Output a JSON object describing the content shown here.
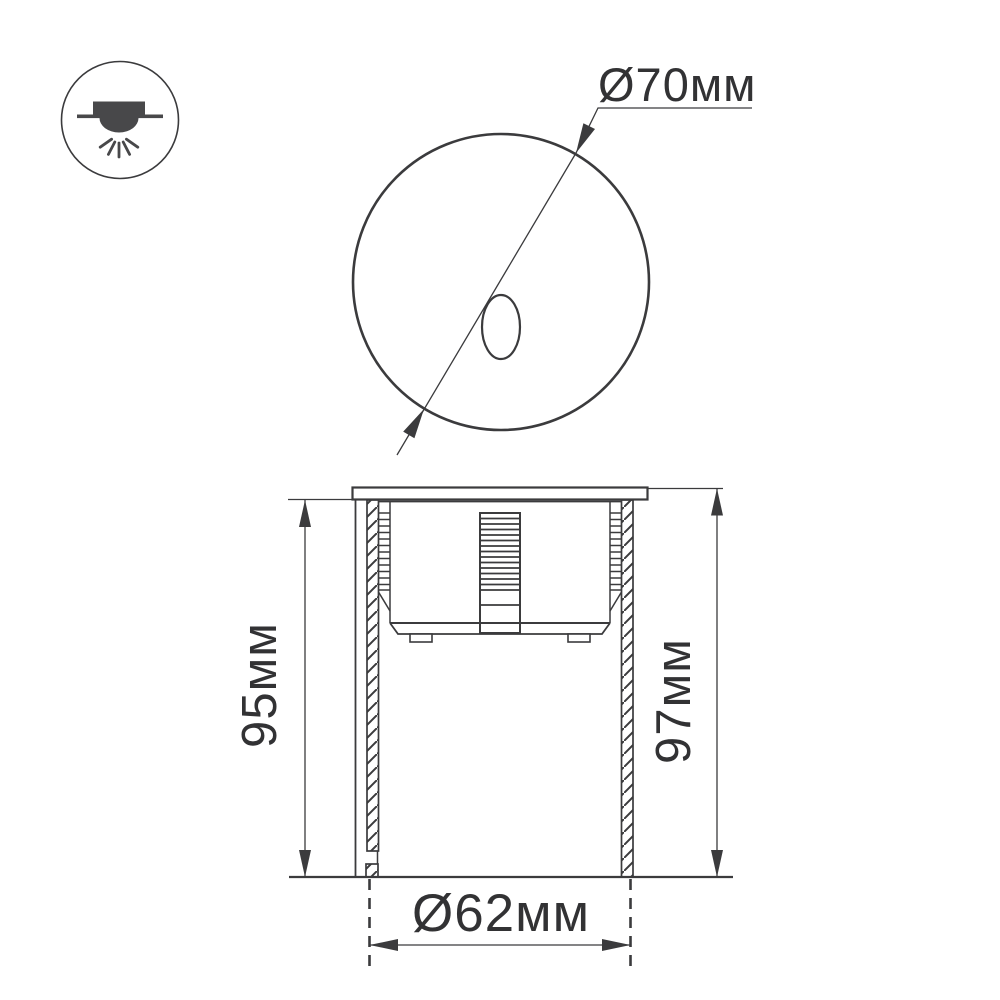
{
  "drawing": {
    "title_semantics": "recessed luminaire dimensional drawing",
    "dimensions": {
      "top_diameter": "Ø70мм",
      "height_left": "95мм",
      "height_right": "97мм",
      "bottom_diameter": "Ø62мм"
    },
    "icon": "recessed-downlight",
    "colors": {
      "line": "#3b3b3d",
      "text": "#323234",
      "icon_fill": "#48484a",
      "background": "#ffffff"
    }
  }
}
